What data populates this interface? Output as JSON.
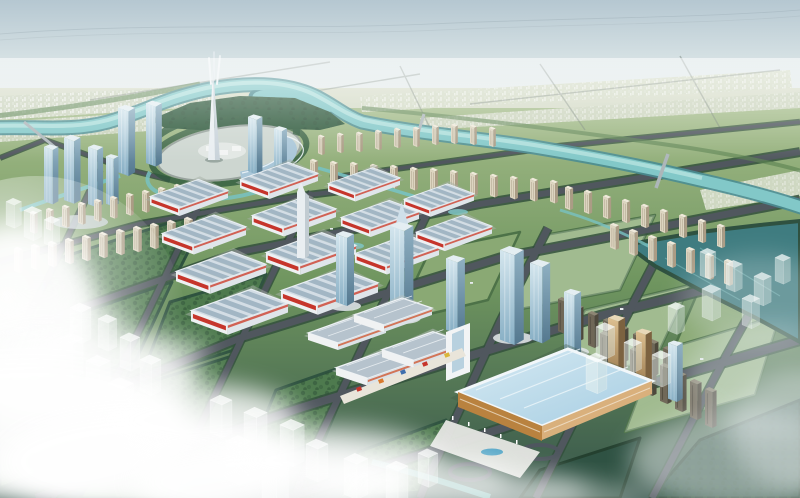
{
  "meta": {
    "title": "Aerial masterplan rendering of a riverside new town",
    "type": "architectural-visualization-birdseye",
    "canvas": {
      "width": 800,
      "height": 498
    }
  },
  "palette": {
    "sky_top": "#b5c7d1",
    "sky_mid": "#dde7e8",
    "horizon": "#f2f4f0",
    "far_plain": "#d6dcc8",
    "far_plain_dark": "#c2cdb2",
    "ground_light": "#a3bb88",
    "ground_mid": "#6f955f",
    "ground_dark": "#35544a",
    "park": "#4e7a4e",
    "park_dark": "#2f5243",
    "field_light": "#8aa974",
    "tree": "#2c5038",
    "river": "#82c8c8",
    "river_deep": "#4a8d92",
    "river_light": "#b4e2de",
    "water_dark": "#3f7c80",
    "road": "#50575e",
    "road_edge": "#33503c",
    "hall_wall": "#eef1f3",
    "hall_roof_a": "#a2b6c4",
    "hall_roof_b": "#d3dde5",
    "sign_red": "#c6352b",
    "glass_light": "#d4e6ee",
    "glass_dark": "#54788f",
    "spire_white": "#e9eef1",
    "residential_cream": "#ddd5c1",
    "residential_shade": "#ab9c85",
    "slab_dark": "#6f6757",
    "amber": "#c9a266",
    "conv_roof_light": "#d6eaf3",
    "conv_roof": "#a6cde2",
    "conv_wall": "#b9823f",
    "conv_wall_light": "#d9b07c",
    "plaza_ground": "#cdd6d0",
    "cloud": "#ffffff",
    "haze": "#e9f0f1"
  },
  "scene": {
    "sky": "hazy pale sky over a flat plain fading to white at the horizon",
    "far_terrain": "low-rise city fabric and fields stretching to the horizon on the far river bank",
    "river": {
      "description": "teal river entering at the left, looping around a forested island behind the central plaza, then flowing across to the lower right edge",
      "bridge_count": 3
    },
    "secondary_water": "dark teal canal basin at the mid-right edge plus small garden canals and ponds through the district",
    "central_plaza": {
      "description": "elliptical civic plaza ringed by trees with a crescent glass canopy on its right side",
      "landmark": "very tall white twin-pronged spire tower",
      "flanking_glass_towers": 4
    },
    "exhibition_district": {
      "description": "staggered rows of white trade-hall sheds with striped blue-grey roofs and red banner signs",
      "hall_count": 13
    },
    "office_row": {
      "description": "diagonal row of blue glass high-rises with white podiums running toward the lower right",
      "tower_count": 8
    },
    "residential": "rows of cream mid-rise slab towers along the river and on both flanks; darker slab rows in the right foreground",
    "exhibition_complexes": {
      "grey_roof_complex": "four-pavilion expo complex with white roof trims and a colourful storefront band",
      "blue_roof_hall": "large flat blue-roofed convention hall with white rim, orange timber walls, forecourt and pool"
    },
    "green_blocks": "tree-lined park and field parcels divided by an orthogonal road grid, several holding translucent massing of future phases",
    "ghost_buildings": "semi-transparent white building volumes marking future construction",
    "clouds": "bright sunlit cloud bank across the lower-left corner with lens glare, thinner haze at the lower right",
    "roads": "dark grey avenues edged with street trees; loop ramps at the lower-right interchange"
  }
}
